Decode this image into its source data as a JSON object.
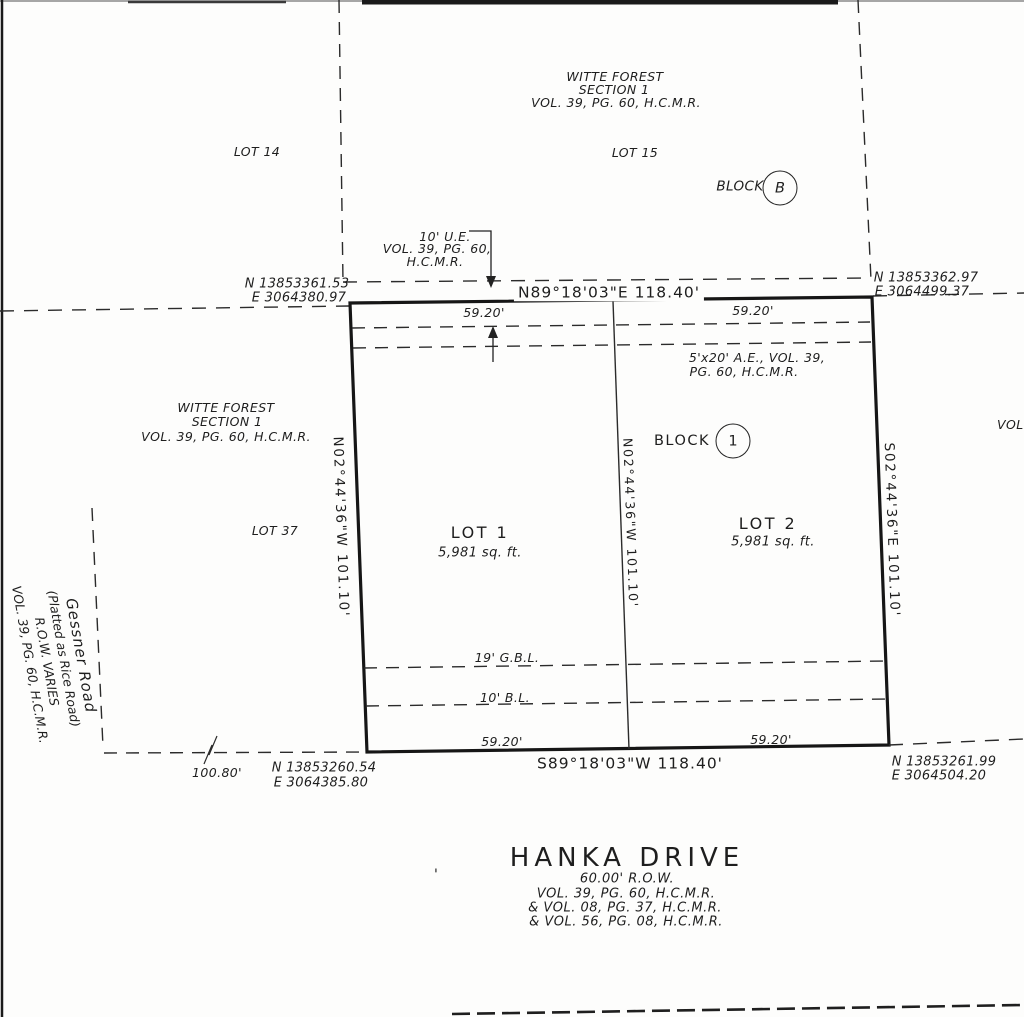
{
  "doc": {
    "north_subdivision": {
      "name": "WITTE FOREST",
      "section": "SECTION 1",
      "ref": "VOL. 39, PG. 60, H.C.M.R."
    },
    "west_subdivision": {
      "name": "WITTE FOREST",
      "section": "SECTION 1",
      "ref": "VOL. 39, PG. 60, H.C.M.R."
    },
    "lot14": "LOT 14",
    "lot15": "LOT 15",
    "lot37": "LOT 37",
    "block_b": {
      "label": "BLOCK",
      "id": "B"
    },
    "block_1": {
      "label": "BLOCK",
      "id": "1"
    },
    "lot1": {
      "name": "LOT 1",
      "area": "5,981 sq. ft."
    },
    "lot2": {
      "name": "LOT 2",
      "area": "5,981 sq. ft."
    },
    "gessner": {
      "name": "Gessner Road",
      "alias": "(Platted as Rice Road)",
      "row": "R.O.W. VARIES",
      "ref": "VOL. 39, PG. 60, H.C.M.R."
    },
    "right_edge_text": "VOL.",
    "ue": {
      "l1": "10' U.E.",
      "l2": "VOL. 39, PG. 60,",
      "l3": "H.C.M.R."
    },
    "ae": {
      "l1": "5'x20' A.E., VOL. 39,",
      "l2": "PG. 60, H.C.M.R."
    },
    "gbl": "19' G.B.L.",
    "bl": "10' B.L.",
    "north_line": {
      "bearing": "N89°18'03\"E  118.40'",
      "left": "59.20'",
      "right": "59.20'"
    },
    "south_line": {
      "bearing": "S89°18'03\"W  118.40'",
      "left": "59.20'",
      "right": "59.20'"
    },
    "west_line": "N02°44'36\"W  101.10'",
    "east_line": "S02°44'36\"E  101.10'",
    "center_line": "N02°44'36\"W  101.10'",
    "gap_west": "100.80'",
    "corners": {
      "nw_n": "N 13853361.53",
      "nw_e": "E 3064380.97",
      "ne_n": "N 13853362.97",
      "ne_e": "E 3064499.37",
      "sw_n": "N 13853260.54",
      "sw_e": "E 3064385.80",
      "se_n": "N 13853261.99",
      "se_e": "E 3064504.20"
    },
    "street": {
      "name": "HANKA DRIVE",
      "row": "60.00' R.O.W.",
      "ref1": "VOL. 39, PG. 60, H.C.M.R.",
      "ref2": "& VOL. 08, PG. 37, H.C.M.R.",
      "ref3": "& VOL. 56, PG. 08, H.C.M.R."
    }
  }
}
